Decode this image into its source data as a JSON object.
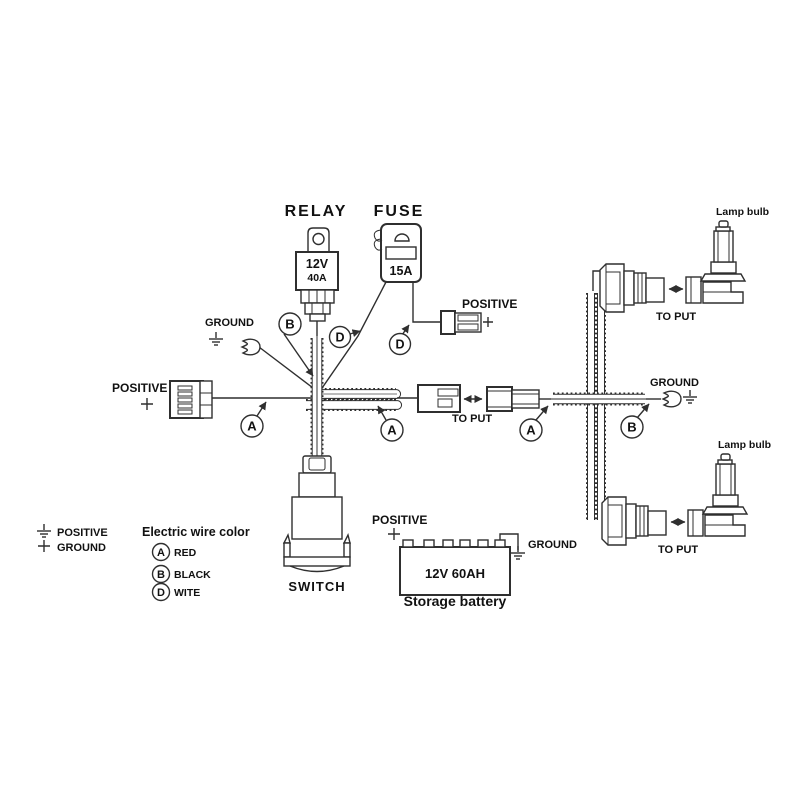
{
  "diagram": {
    "title_relay": "RELAY",
    "relay": {
      "volt": "12V",
      "amp": "40A"
    },
    "title_fuse": "FUSE",
    "fuse": {
      "amp": "15A"
    },
    "labels": {
      "positive": "POSITIVE",
      "ground": "GROUND",
      "to_put": "TO PUT",
      "lamp_bulb": "Lamp bulb",
      "switch": "SWITCH"
    },
    "wire_codes": {
      "a": "A",
      "b": "B",
      "d": "D"
    },
    "battery": {
      "rating": "12V 60AH",
      "caption": "Storage battery"
    },
    "legend": {
      "positive": "POSITIVE",
      "ground": "GROUND",
      "title": "Electric wire color",
      "entries": [
        {
          "code": "A",
          "color": "RED"
        },
        {
          "code": "B",
          "color": "BLACK"
        },
        {
          "code": "D",
          "color": "WITE"
        }
      ]
    },
    "colors": {
      "line": "#2f2f2f",
      "text": "#111111",
      "background": "#ffffff"
    }
  }
}
